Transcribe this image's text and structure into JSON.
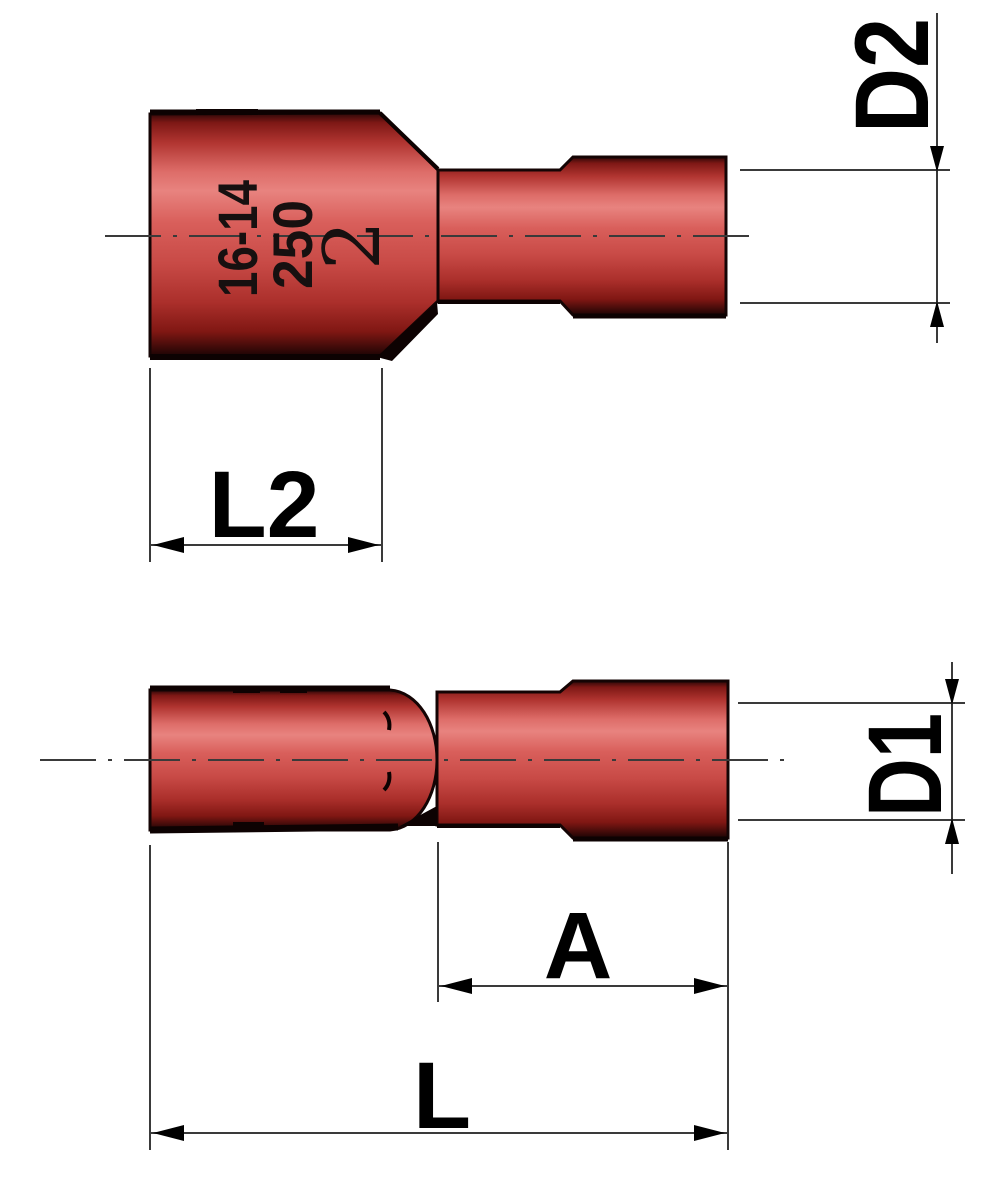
{
  "page": {
    "background": "#ffffff",
    "description": "Technical drawing of a red fully-insulated female disconnect terminal shown in two views with dimension callouts"
  },
  "dimensions": {
    "d2": "D2",
    "l2": "L2",
    "d1": "D1",
    "a": "A",
    "l": "L"
  },
  "part_markings": {
    "wire_gauge": "16-14",
    "tab_size": "250",
    "logo": "2"
  },
  "colors": {
    "insulation_highlight": "#e8837f",
    "insulation_mid": "#d95f5b",
    "insulation_dark": "#801713",
    "outline": "#140404",
    "dimension_line": "#3a3a3a",
    "label_text": "#000000"
  }
}
